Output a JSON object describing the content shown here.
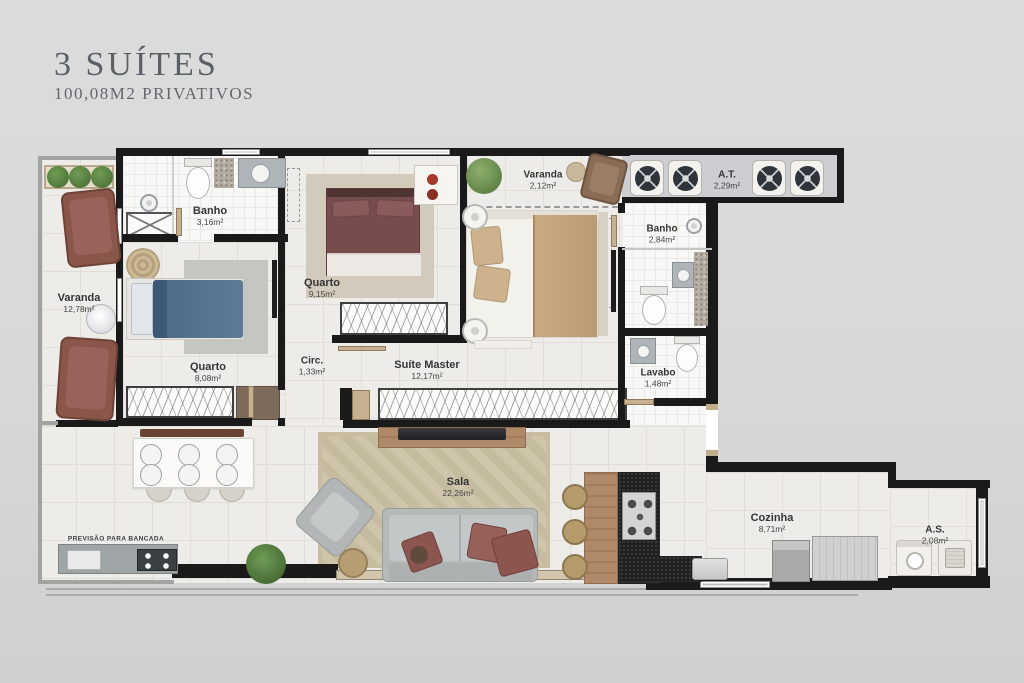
{
  "header": {
    "title": "3 SUÍTES",
    "subtitle": "100,08M2 PRIVATIVOS"
  },
  "rooms": {
    "varanda_left": {
      "name": "Varanda",
      "area": "12,78m²"
    },
    "banho_social": {
      "name": "Banho",
      "area": "3,16m²"
    },
    "quarto_1": {
      "name": "Quarto",
      "area": "8,08m²"
    },
    "quarto_2": {
      "name": "Quarto",
      "area": "9,15m²"
    },
    "circulacao": {
      "name": "Circ.",
      "area": "1,33m²"
    },
    "suite_master": {
      "name": "Suíte Master",
      "area": "12,17m²"
    },
    "varanda_suite": {
      "name": "Varanda",
      "area": "2,12m²"
    },
    "area_tecnica": {
      "name": "A.T.",
      "area": "2,29m²"
    },
    "banho_suite": {
      "name": "Banho",
      "area": "2,84m²"
    },
    "lavabo": {
      "name": "Lavabo",
      "area": "1,48m²"
    },
    "sala": {
      "name": "Sala",
      "area": "22,26m²"
    },
    "cozinha": {
      "name": "Cozinha",
      "area": "8,71m²"
    },
    "area_servico": {
      "name": "A.S.",
      "area": "2,08m²"
    }
  },
  "annotations": {
    "bancada": "PREVISÃO PARA BANCADA"
  },
  "palette": {
    "background": "#d9dada",
    "walls": "#1a1a1a",
    "floor": "#edece8",
    "bath_floor": "#f8f8f7",
    "wood": "#b08968",
    "bed_blue": "#567290",
    "bed_maroon": "#7b4f4f",
    "blanket_tan": "#c2a37c",
    "sofa_gray": "#bcbfc0",
    "label_text": "#3a3a3a",
    "title_text": "#5b6067"
  }
}
